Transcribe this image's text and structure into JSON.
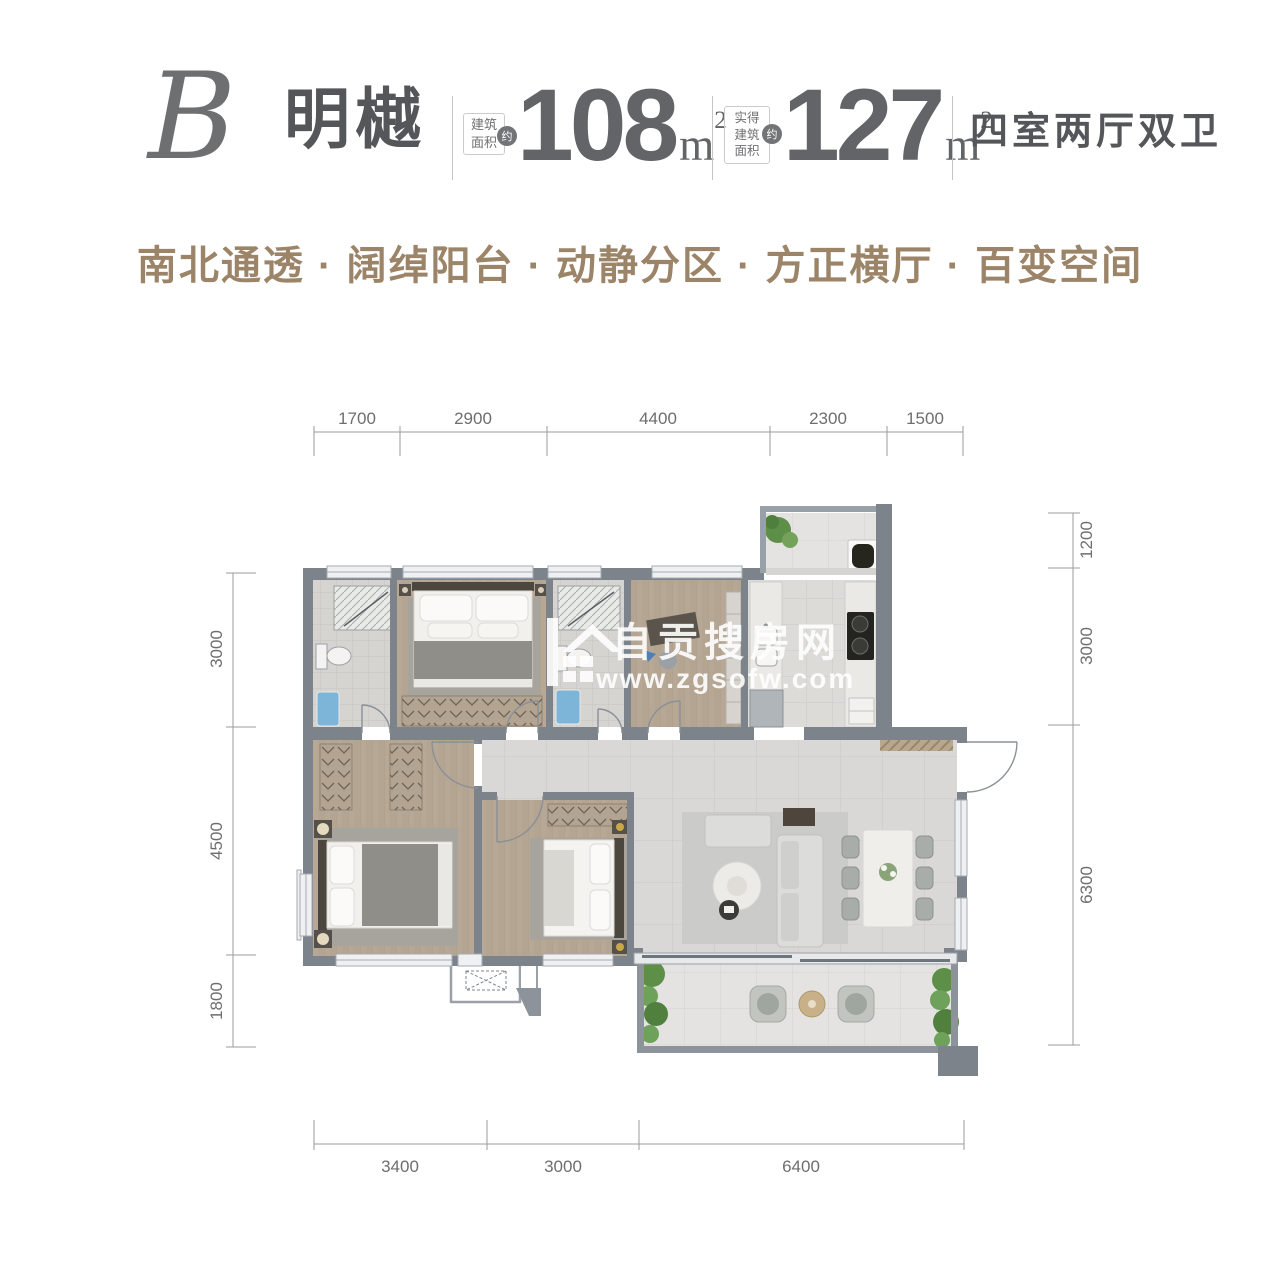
{
  "header": {
    "unit_letter": "B",
    "unit_name": "明樾",
    "area_build": {
      "label": "建筑\n面积",
      "approx": "约",
      "value": "108",
      "unit": "m",
      "unit_sup": "2"
    },
    "area_actual": {
      "label": "实得\n建筑\n面积",
      "approx": "约",
      "value": "127",
      "unit": "m",
      "unit_sup": "2"
    },
    "layout": "四室两厅双卫"
  },
  "tagline": "南北通透 · 阔绰阳台 · 动静分区 · 方正横厅 · 百变空间",
  "dimensions": {
    "top": [
      "1700",
      "2900",
      "4400",
      "2300",
      "1500"
    ],
    "bottom": [
      "3400",
      "3000",
      "6400"
    ],
    "left": [
      "3000",
      "4500",
      "1800"
    ],
    "right": [
      "1200",
      "3000",
      "6300"
    ]
  },
  "watermark": {
    "site": "自贡搜房网",
    "url": "www.zgsofw.com"
  },
  "colors": {
    "heading_text": "#55565A",
    "number_text": "#636467",
    "tagline_text": "#9C8468",
    "wall": "#7D838B",
    "wood_floor": "#B7A896",
    "tile_floor": "#D9D8D6",
    "balcony_floor": "#E4E3E1",
    "plant_green": "#5D8F49",
    "sink_blue": "#7DB5D9",
    "dimension_line": "#9B9B9B"
  }
}
